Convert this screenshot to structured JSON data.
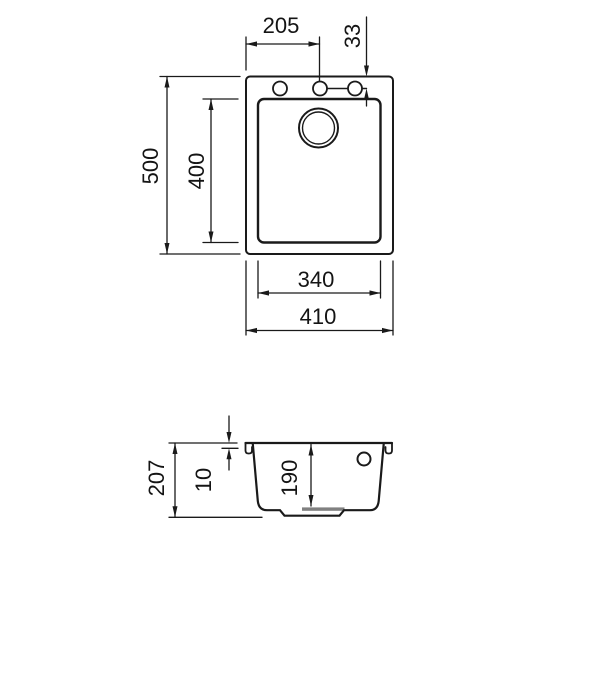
{
  "drawing": {
    "type": "sink-installation-diagram",
    "views": {
      "top": {
        "name": "top view",
        "dims": {
          "overall_width": "410",
          "bowl_width": "340",
          "overall_depth": "500",
          "bowl_depth": "400",
          "tap_hole_offset": "205",
          "tap_hole_edge_distance": "33"
        },
        "features": [
          "tap-hole-left",
          "tap-hole-center",
          "tap-hole-right",
          "drain-hole"
        ]
      },
      "section": {
        "name": "section view",
        "dims": {
          "overall_height": "207",
          "rim_thickness": "10",
          "bowl_inner_depth": "190"
        },
        "features": [
          "overflow-hole",
          "drain-recess"
        ]
      }
    },
    "colors": {
      "line": "#1a1a1a",
      "background": "#ffffff",
      "drain_shade": "#808080"
    }
  }
}
